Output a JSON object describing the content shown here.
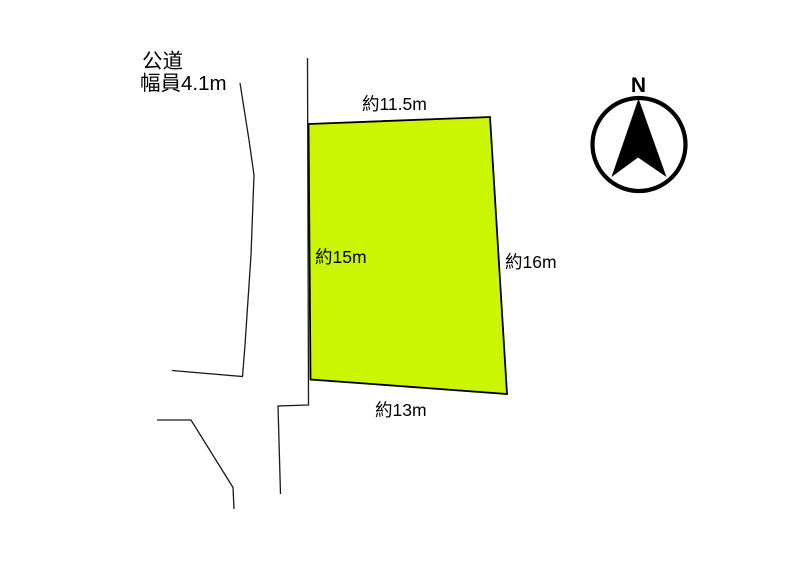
{
  "page": {
    "background": "#ffffff"
  },
  "diagram": {
    "type": "land-plot-site-plan",
    "road": {
      "label_line1": "公道",
      "label_line2": "幅員4.1m"
    },
    "plot": {
      "fill": "#cbf500",
      "dimensions": {
        "top": "約11.5m",
        "left": "約15m",
        "right": "約16m",
        "bottom": "約13m"
      }
    },
    "compass": {
      "label": "N"
    },
    "colors": {
      "line": "#000000",
      "plot_outline": "#000000",
      "text": "#000000"
    }
  }
}
